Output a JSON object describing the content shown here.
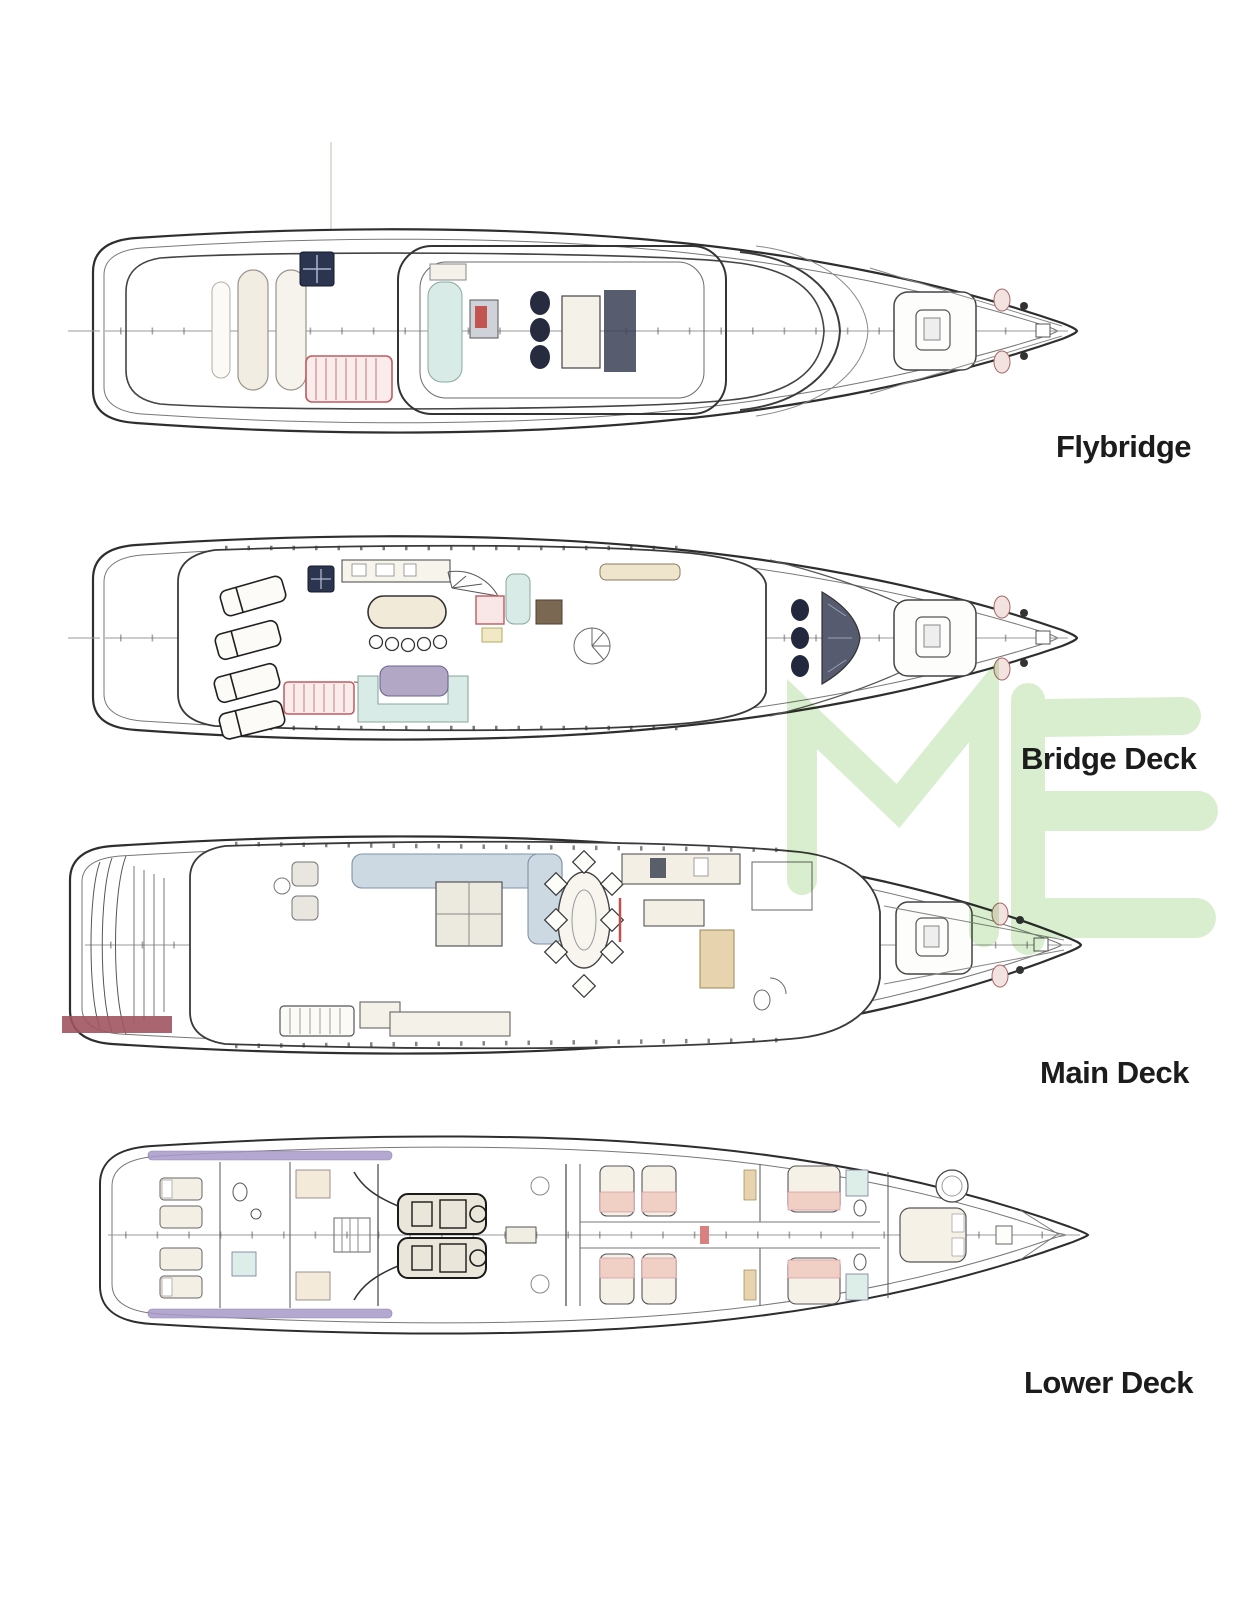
{
  "page": {
    "background": "#ffffff"
  },
  "decks": [
    {
      "id": "flybridge",
      "label": "Flybridge"
    },
    {
      "id": "bridge-deck",
      "label": "Bridge Deck"
    },
    {
      "id": "main-deck",
      "label": "Main Deck"
    },
    {
      "id": "lower-deck",
      "label": "Lower Deck"
    }
  ],
  "watermark": {
    "text": "ME",
    "color": "#d7eecd"
  },
  "palette": {
    "label_text": "#1c1c1c",
    "hull_line": "#2e2e2e",
    "inner_line": "#777777",
    "stair_red": "#c05a60",
    "skylight_navy": "#2b3550",
    "seat_teal": "#d8ebe7",
    "table_purple": "#b2a8c6",
    "sofa_blue": "#ccd8e2",
    "passerelle_maroon": "#a05560",
    "rail_purple": "#a79ac9",
    "wood_tan": "#e7d3ae",
    "blanket_salmon": "#f0cfc4"
  }
}
